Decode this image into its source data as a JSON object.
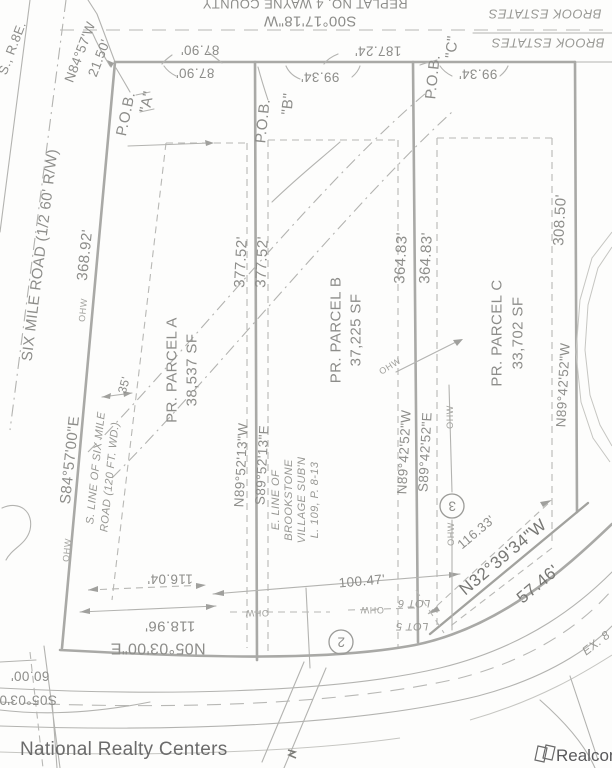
{
  "colors": {
    "background": "#fdfdfc",
    "linework": "#b3b3b0",
    "boundary_line": "#a9a9a6",
    "text": "#8d8d8a",
    "text_dark": "#777774",
    "watermark_left": "#6b6b6b",
    "watermark_right": "#59595b"
  },
  "labels": {
    "plat_note": "REPLAT NO. 4 WAYNE COUNTY",
    "bearing_top": "S00°17'18\"W",
    "brook_estates": "BROOK ESTATES",
    "dim_187_24": "187.24'",
    "dim_87_90": "87.90'",
    "dim_99_34": "99.34'",
    "bearing_nw": "N84°57'W",
    "dim_21_50": "21.50'",
    "pob": "P.O.B.",
    "pob_a": "\"A\"",
    "pob_b": "\"B\"",
    "pob_c": "\"C\"",
    "sec_note": "S., R.8E.",
    "six_mile_road": "SIX MILE ROAD (1/2 60' R/W)",
    "dim_368_92": "368.92'",
    "bearing_s84": "S84°57'00\"E",
    "s_line_1": "S. LINE OF SIX MILE",
    "s_line_2": "ROAD (120 FT. WD.)",
    "dim_35": "35'",
    "dim_377_52": "377.52'",
    "bearing_n8952": "N89°52'13\"W",
    "bearing_s8952": "S89°52'13\"E",
    "dim_364_83": "364.83'",
    "bearing_n8942": "N89°42'52\"W",
    "bearing_s8942": "S89°42'52\"E",
    "dim_308_50": "308.50'",
    "parcel_a_name": "PR. PARCEL A",
    "parcel_a_area": "38,537 SF",
    "parcel_b_name": "PR. PARCEL B",
    "parcel_b_area": "37,225 SF",
    "parcel_c_name": "PR. PARCEL C",
    "parcel_c_area": "33,702 SF",
    "e_line_1": "E. LINE OF",
    "e_line_2": "BROOKSTONE",
    "e_line_3": "VILLAGE SUB'N",
    "e_line_4": "L. 109, P. 8-13",
    "dim_116_04": "116.04'",
    "dim_118_96": "118.96'",
    "bearing_n05": "N05°03'00\"E",
    "dim_100_47": "100.47'",
    "dim_60_00": "60.00'",
    "bearing_s05": "S05°03'0",
    "dim_116_33": "116.33'",
    "bearing_n32": "N32°39'34\"W",
    "dim_57_46": "57.46'",
    "lot_5": "LOT 5",
    "lot_6": "LOT 6",
    "ex_road": "EX. 8",
    "ohw": "OHW",
    "curve_2": "2",
    "curve_3": "3"
  },
  "watermarks": {
    "left": "National Realty Centers",
    "right": "Realcomp"
  }
}
